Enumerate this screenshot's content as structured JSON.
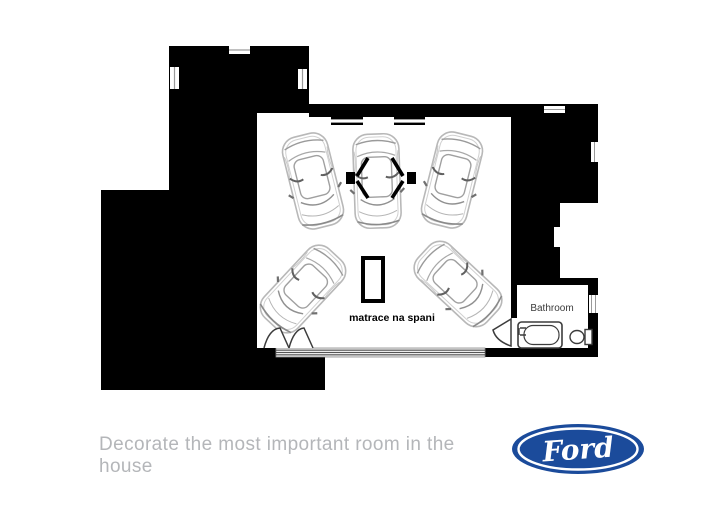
{
  "plan": {
    "bathroom_label": "Bathroom",
    "mattress_label": "matrace na spani"
  },
  "footer": {
    "tagline": "Decorate the most important room in the house",
    "brand_label": "Ford"
  },
  "colors": {
    "wall_black": "#000000",
    "ford_blue": "#1b4b9b",
    "tagline_gray": "#b4b6b9",
    "car_outline_gray": "#b0b0b0"
  }
}
